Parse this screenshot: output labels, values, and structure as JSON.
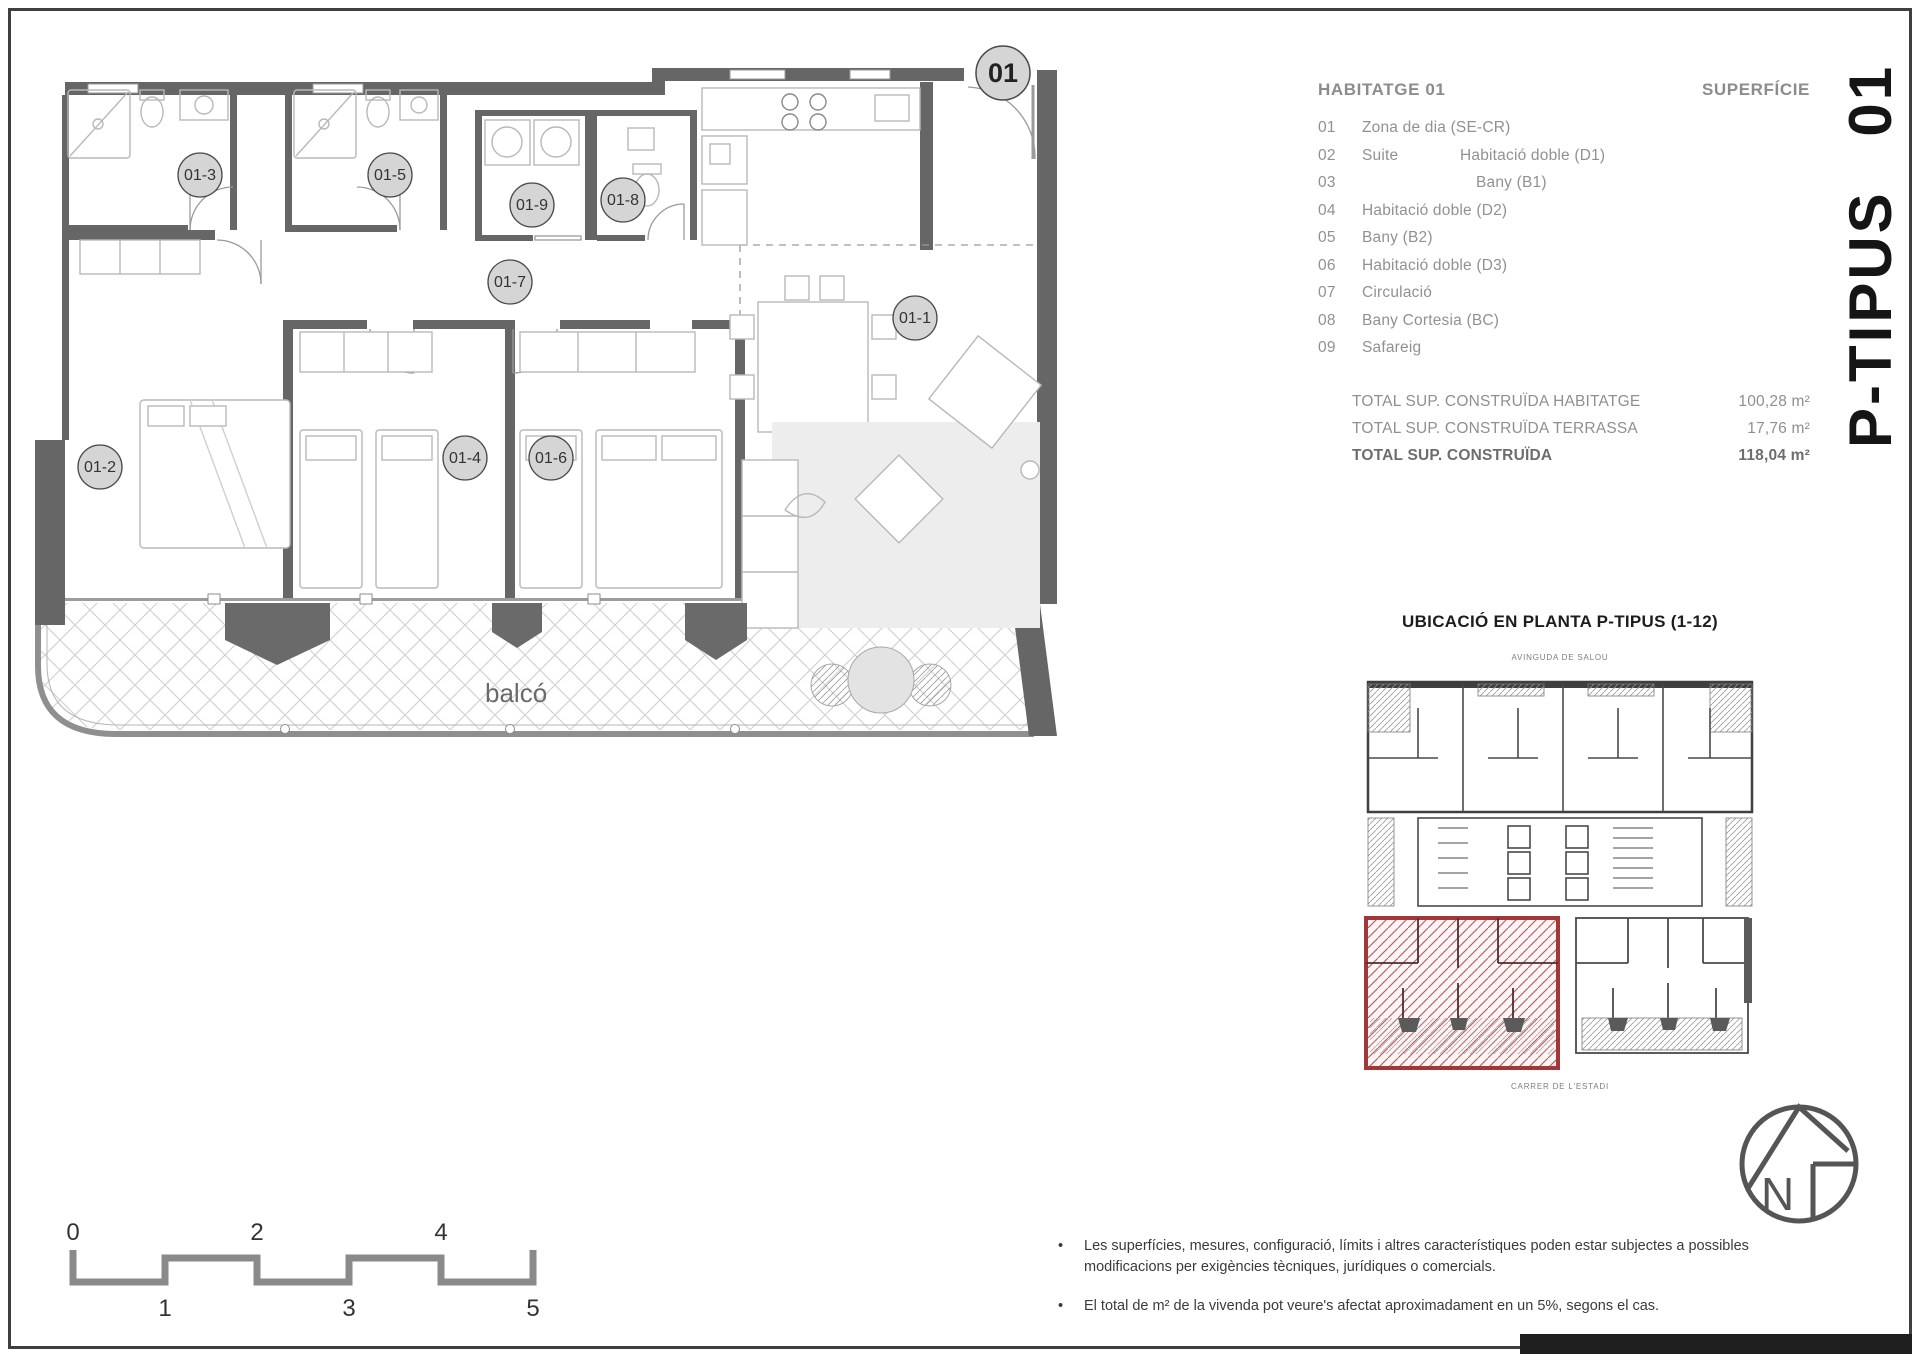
{
  "plan": {
    "unit_bubble": "01",
    "balcony_label": "balcó",
    "room_bubbles": [
      "01-1",
      "01-2",
      "01-3",
      "01-4",
      "01-5",
      "01-6",
      "01-7",
      "01-8",
      "01-9"
    ]
  },
  "legend": {
    "title": "HABITATGE 01",
    "superficie_header": "SUPERFÍCIE",
    "items": [
      {
        "num": "01",
        "col1": "Zona de dia (SE-CR)",
        "col2": ""
      },
      {
        "num": "02",
        "col1": "Suite",
        "col2": "Habitació doble (D1)"
      },
      {
        "num": "03",
        "col1": "",
        "col2": "Bany (B1)"
      },
      {
        "num": "04",
        "col1": "Habitació doble (D2)",
        "col2": ""
      },
      {
        "num": "05",
        "col1": "Bany (B2)",
        "col2": ""
      },
      {
        "num": "06",
        "col1": "Habitació doble (D3)",
        "col2": ""
      },
      {
        "num": "07",
        "col1": "Circulació",
        "col2": ""
      },
      {
        "num": "08",
        "col1": "Bany Cortesia (BC)",
        "col2": ""
      },
      {
        "num": "09",
        "col1": "Safareig",
        "col2": ""
      }
    ],
    "totals": [
      {
        "label": "TOTAL SUP. CONSTRUÏDA HABITATGE",
        "value": "100,28 m²"
      },
      {
        "label": "TOTAL SUP. CONSTRUÏDA TERRASSA",
        "value": "17,76 m²"
      },
      {
        "label": "TOTAL SUP. CONSTRUÏDA",
        "value": "118,04 m²"
      }
    ]
  },
  "sheet_title_vertical": "P-TIPUS 01",
  "location": {
    "title": "UBICACIÓ EN PLANTA P-TIPUS (1-12)",
    "street_top": "AVINGUDA DE SALOU",
    "street_bottom": "CARRER DE L'ESTADI"
  },
  "north_letter": "N",
  "scalebar": {
    "labels_top": [
      "0",
      "2",
      "4"
    ],
    "labels_bottom": [
      "1",
      "3",
      "5"
    ]
  },
  "ui": {
    "bullet": "•"
  },
  "notes": [
    "Les superfícies, mesures, configuració, límits i altres característiques poden estar subjectes a possibles modificacions per exigències tècniques, jurídiques o comercials.",
    "El total de m² de la vivenda pot veure's afectat aproximadament en un 5%, segons el cas."
  ],
  "colors": {
    "wall": "#666666",
    "thin_line": "#a0a0a0",
    "furniture": "#b8b8b8",
    "bubble_fill": "#d5d5d5",
    "highlight_red": "#a33636",
    "heading_gray": "#8c8c8c",
    "text_dark": "#1d1d1d"
  }
}
